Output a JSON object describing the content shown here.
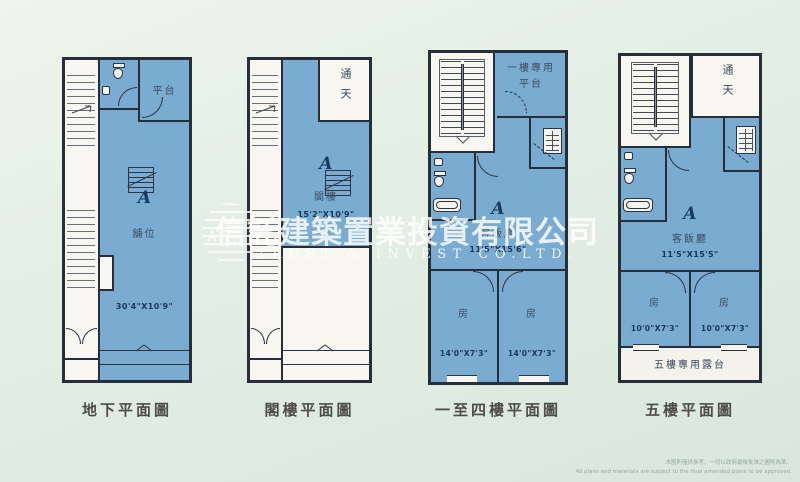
{
  "watermark": {
    "company_cn": "信託建築置業投資有限公司",
    "company_en": "TRUST & INVEST CO.LTD.",
    "logo_text": "A.T."
  },
  "plans": [
    {
      "caption": "地下平面圖",
      "unit": "A",
      "room": "舖位",
      "dimensions": "30'4\"X10'9\"",
      "terrace": "平台"
    },
    {
      "caption": "閣樓平面圖",
      "unit": "A",
      "room": "閣樓",
      "dimensions": "15'2\"X10'9\"",
      "void": "通天"
    },
    {
      "caption": "一至四樓平面圖",
      "unit": "A",
      "terrace": "一樓專用平台",
      "living_room": "客飯廳",
      "living_dimensions": "11'5\"X15'6\"",
      "bedroom": "房",
      "bedroom_dimensions": "14'0\"X7'3\""
    },
    {
      "caption": "五樓平面圖",
      "unit": "A",
      "void": "通天",
      "living_room": "客飯廳",
      "living_dimensions": "11'5\"X15'5\"",
      "bedroom": "房",
      "bedroom_dimensions": "10'0\"X7'3\"",
      "balcony": "五樓專用露台"
    }
  ],
  "footnote": {
    "line1_cn": "本圖則僅供參考，一切以政府最後批准之圖則為準。",
    "line2_en": "All plans and materials are subject to the final amended plans to be approved."
  },
  "icons": {
    "stairs": "stair treads",
    "toilet": "WC",
    "washbasin": "basin",
    "bathtub": "tub",
    "kitchen_sink": "sink with grid",
    "door": "quarter-circle swing arc",
    "shutter_chevron": "shopfront chevron"
  },
  "colors": {
    "background": "#e2eee3",
    "plan_fill": "#7aabd1",
    "wall": "#262e3a",
    "watermark": "#ffffff"
  }
}
